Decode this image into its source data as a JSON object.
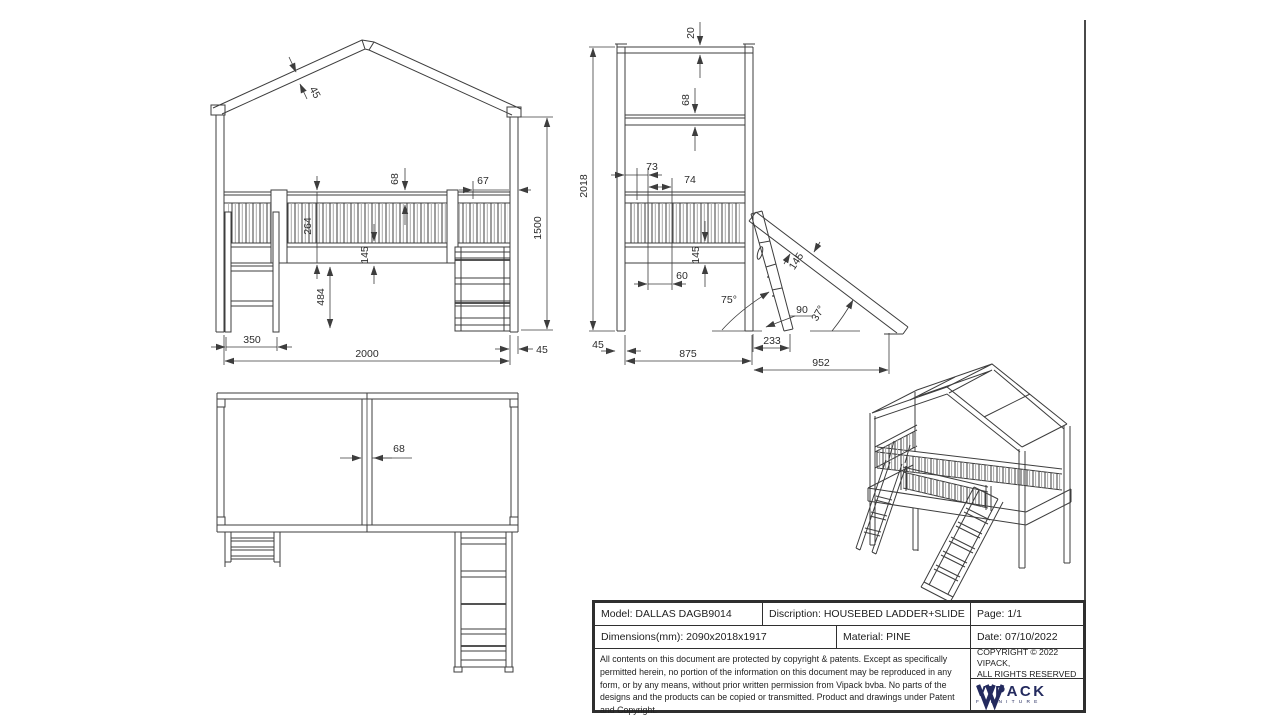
{
  "drawing": {
    "front_view": {
      "dims": {
        "roof_beam": "45",
        "rail_beam": "68",
        "rail_end_offset": "67",
        "railing_height": "264",
        "platform_thickness": "145",
        "under_clearance": "484",
        "ladder_width": "350",
        "bed_length": "2000",
        "post_width": "45",
        "eave_height": "1500"
      }
    },
    "side_view": {
      "dims": {
        "ridge_beam": "20",
        "eave_beam": "68",
        "gap_a": "73",
        "gap_b": "74",
        "total_height": "2018",
        "platform_thickness": "145",
        "gap_c": "60",
        "slide_width": "145",
        "ladder_gap": "90",
        "ladder_angle": "75°",
        "slide_angle": "37°",
        "post_width": "45",
        "bed_depth": "875",
        "ladder_run": "233",
        "slide_run": "952"
      }
    },
    "top_view": {
      "dims": {
        "divider_width": "68"
      }
    }
  },
  "title_block": {
    "model": "Model: DALLAS DAGB9014",
    "description": "Discription: HOUSEBED LADDER+SLIDE",
    "page": "Page: 1/1",
    "dimensions": "Dimensions(mm): 2090x2018x1917",
    "material": "Material: PINE",
    "date": "Date: 07/10/2022",
    "legal": "All contents on this document are protected by copyright & patents. Except as specifically permitted herein, no portion of the information on this document may be reproduced in any form, or by any means, without prior written permission from Vipack bvba. No parts of the designs and the products can be copied or transmitted. Product and drawings under Patent and Copyright.",
    "copyright_line1": "COPYRIGHT  © 2022 VIPACK,",
    "copyright_line2": "ALL RIGHTS RESERVED",
    "brand": "VIPACK",
    "brand_sub": "FURNITURE"
  },
  "colors": {
    "line": "#3d3d3d",
    "text": "#2c2c2c",
    "muted": "#a8a8a8",
    "navy": "#232a5e"
  }
}
